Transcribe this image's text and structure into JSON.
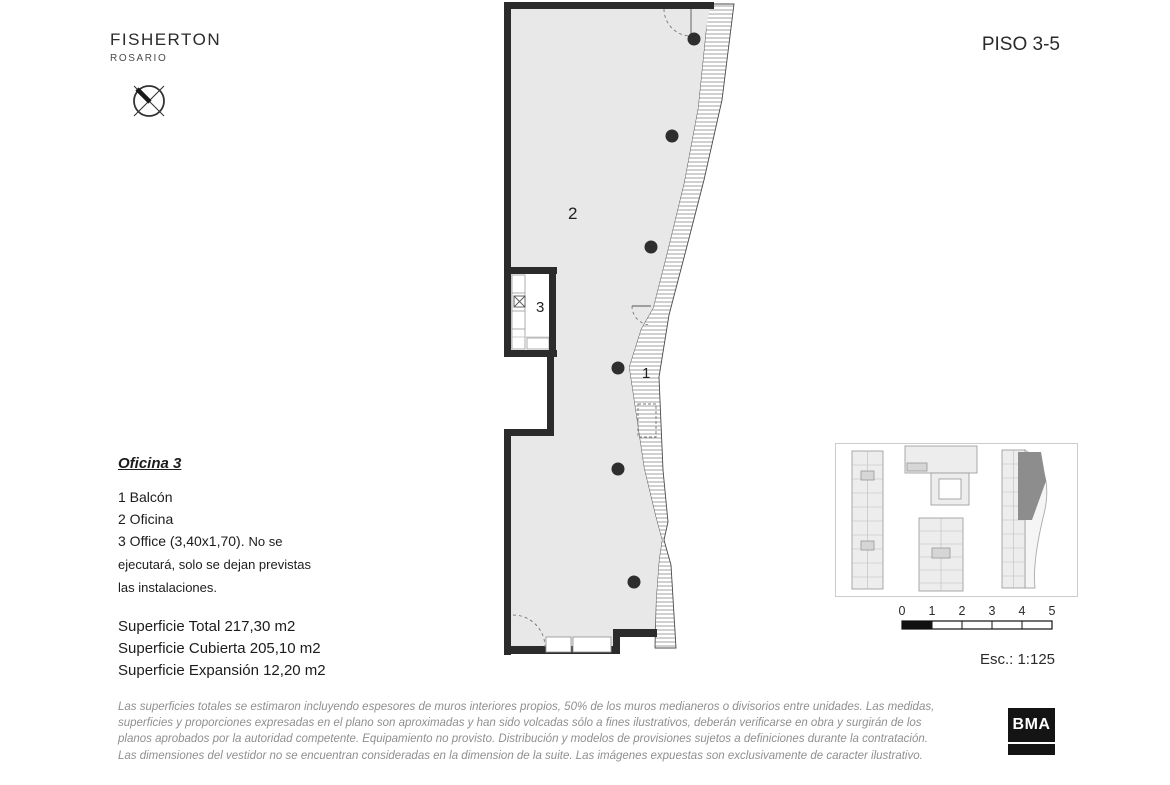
{
  "header": {
    "brand": "FISHERTON",
    "brand_sub": "ROSARIO",
    "floor_label": "PISO 3-5"
  },
  "plan": {
    "labels": {
      "balcony": "1",
      "office": "2",
      "kitchen": "3"
    }
  },
  "legend": {
    "title": "Oficina 3",
    "items": [
      "1 Balcón",
      "2 Oficina"
    ],
    "item3_main": "3 Office (3,40x1,70).",
    "item3_note": "No se ejecutará, solo se dejan previstas las instalaciones."
  },
  "areas": [
    "Superficie Total 217,30 m2",
    "Superficie Cubierta 205,10 m2",
    "Superficie Expansión 12,20 m2"
  ],
  "scalebar": {
    "ticks": [
      "0",
      "1",
      "2",
      "3",
      "4",
      "5"
    ],
    "scale_label": "Esc.: 1:125"
  },
  "disclaimer": [
    "Las superficies totales se estimaron incluyendo espesores de muros interiores propios, 50% de los muros medianeros o divisorios entre unidades. Las medidas,",
    "superficies y proporciones expresadas en el plano son aproximadas y han sido volcadas sólo a fines ilustrativos, deberán verificarse en obra y surgirán de los",
    "planos aprobados por la autoridad competente. Equipamiento no provisto. Distribución y modelos de provisiones sujetos a definiciones durante la contratación.",
    "Las dimensiones del vestidor no se encuentran consideradas en la dimension de la suite. Las imágenes expuestas son exclusivamente de caracter ilustrativo."
  ],
  "logo": {
    "text": "BMA"
  },
  "colors": {
    "plan_fill": "#e8e8e8",
    "wall": "#2b2b2b",
    "muted_text": "#8f8f8f",
    "keyplan_highlight": "#8d8d8d"
  }
}
